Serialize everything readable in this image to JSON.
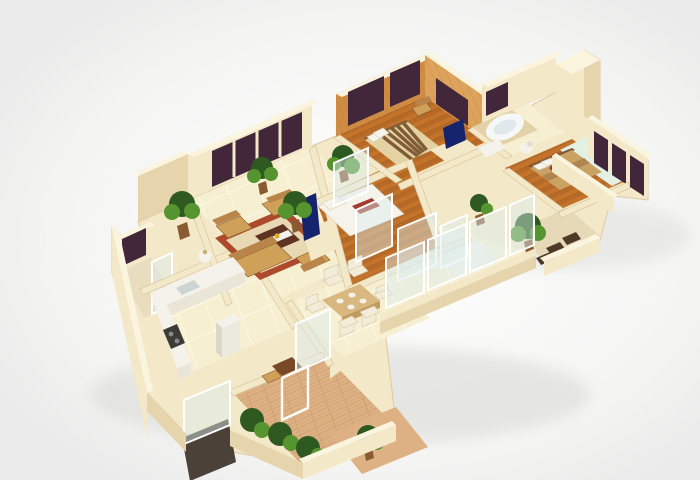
{
  "scene": {
    "type": "3d-floor-plan-render",
    "view": "isometric-birds-eye",
    "contains_text": false,
    "rooms": [
      "living-room",
      "master-bedroom",
      "bedroom-2",
      "bedroom-3",
      "jacuzzi-bathroom",
      "second-bathroom",
      "kitchen",
      "dining-area",
      "entry-foyer",
      "kitchen-balcony",
      "right-balcony",
      "terrace-balcony",
      "hallway"
    ],
    "notable_objects": [
      "sofa-set",
      "area-rug",
      "coffee-table",
      "flat-tv",
      "striped-double-bed",
      "white-double-bed",
      "tan-double-bed",
      "dining-table-with-chairs",
      "kitchen-counter-with-stove-and-sink",
      "refrigerator",
      "corner-jacuzzi",
      "toilet",
      "vanity",
      "potted-plants",
      "glass-sliding-doors",
      "dark-tinted-windows",
      "wood-paneled-walls",
      "entry-door-mat"
    ]
  },
  "palette": {
    "bg": "#ebebeb",
    "glow": "#ffffff",
    "wallFace": "#f3e8c8",
    "wallTop": "#fbf5e0",
    "wallShade": "#e6d4ac",
    "tileFloor": "#f6efd2",
    "tileLine": "#fffbe8",
    "woodFloor": "#c4732b",
    "parquetFloor": "#ddb183",
    "panelWood": "#cf8c42",
    "panelWoodLight": "#dda35c",
    "windowGlass": "#42263a",
    "tvScreen": "#16246d",
    "glassPanel": "#dceef0",
    "carpetBorder": "#ad4a2c",
    "carpetField": "#e9d8b4",
    "sofa": "#cfa058",
    "furnitureDark": "#5e3322",
    "bedWhite": "#f6f3ea",
    "bedTan": "#c9a264",
    "bedStripeDark": "#7f5c36",
    "bedStripeLight": "#e4d2a2",
    "plantDark": "#2e5a21",
    "plantLight": "#55942f",
    "potBrown": "#8a5a33",
    "counterWhite": "#f4f2ea",
    "stoveDark": "#3b3b38",
    "benchBrown": "#4f3a28",
    "matDark": "#4b4138",
    "accentRed": "#a03c30"
  }
}
